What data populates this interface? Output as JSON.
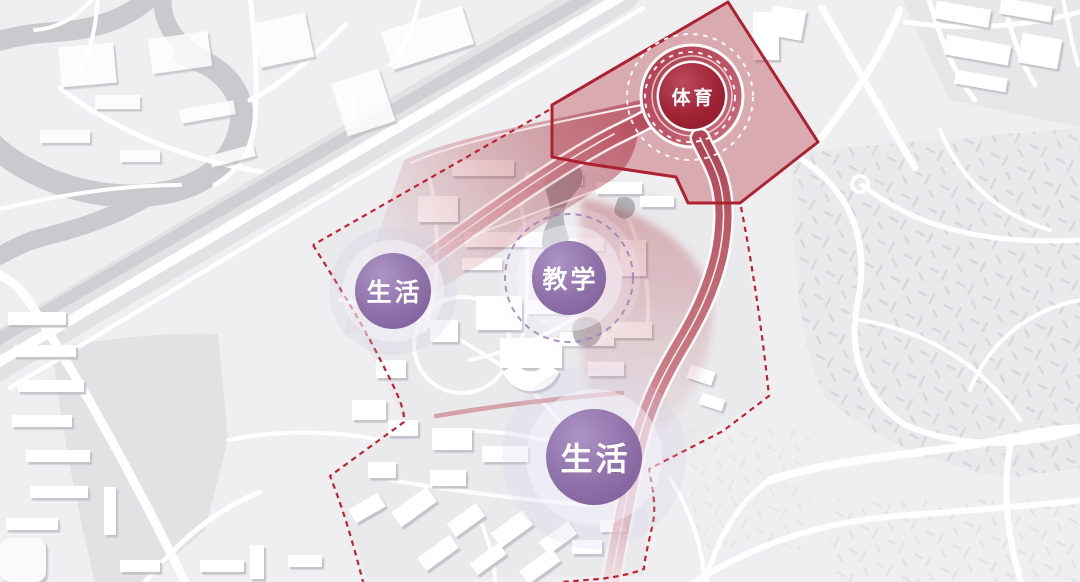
{
  "diagram": {
    "kind": "campus master-plan zoning and flow concept over city basemap",
    "zones": [
      {
        "id": "sports",
        "label": "体育",
        "color": "#a02335"
      },
      {
        "id": "living-west",
        "label": "生活",
        "color": "#8d6fa7"
      },
      {
        "id": "teaching",
        "label": "教学",
        "color": "#8d6fa7"
      },
      {
        "id": "living-south",
        "label": "生活",
        "color": "#8d6fa7"
      }
    ],
    "overlay_colors": {
      "precinct_outline": "#ad2230",
      "precinct_fill": "rgba(173,34,48,0.33)",
      "flow_ribbon": "#a82a3c",
      "site_boundary_dashed": "#c1242e",
      "teaching_ring_dashed": "#8a63a8",
      "sports_rings_dashed": "#ffffff",
      "halo": "rgba(248,247,252,0.5)"
    }
  }
}
